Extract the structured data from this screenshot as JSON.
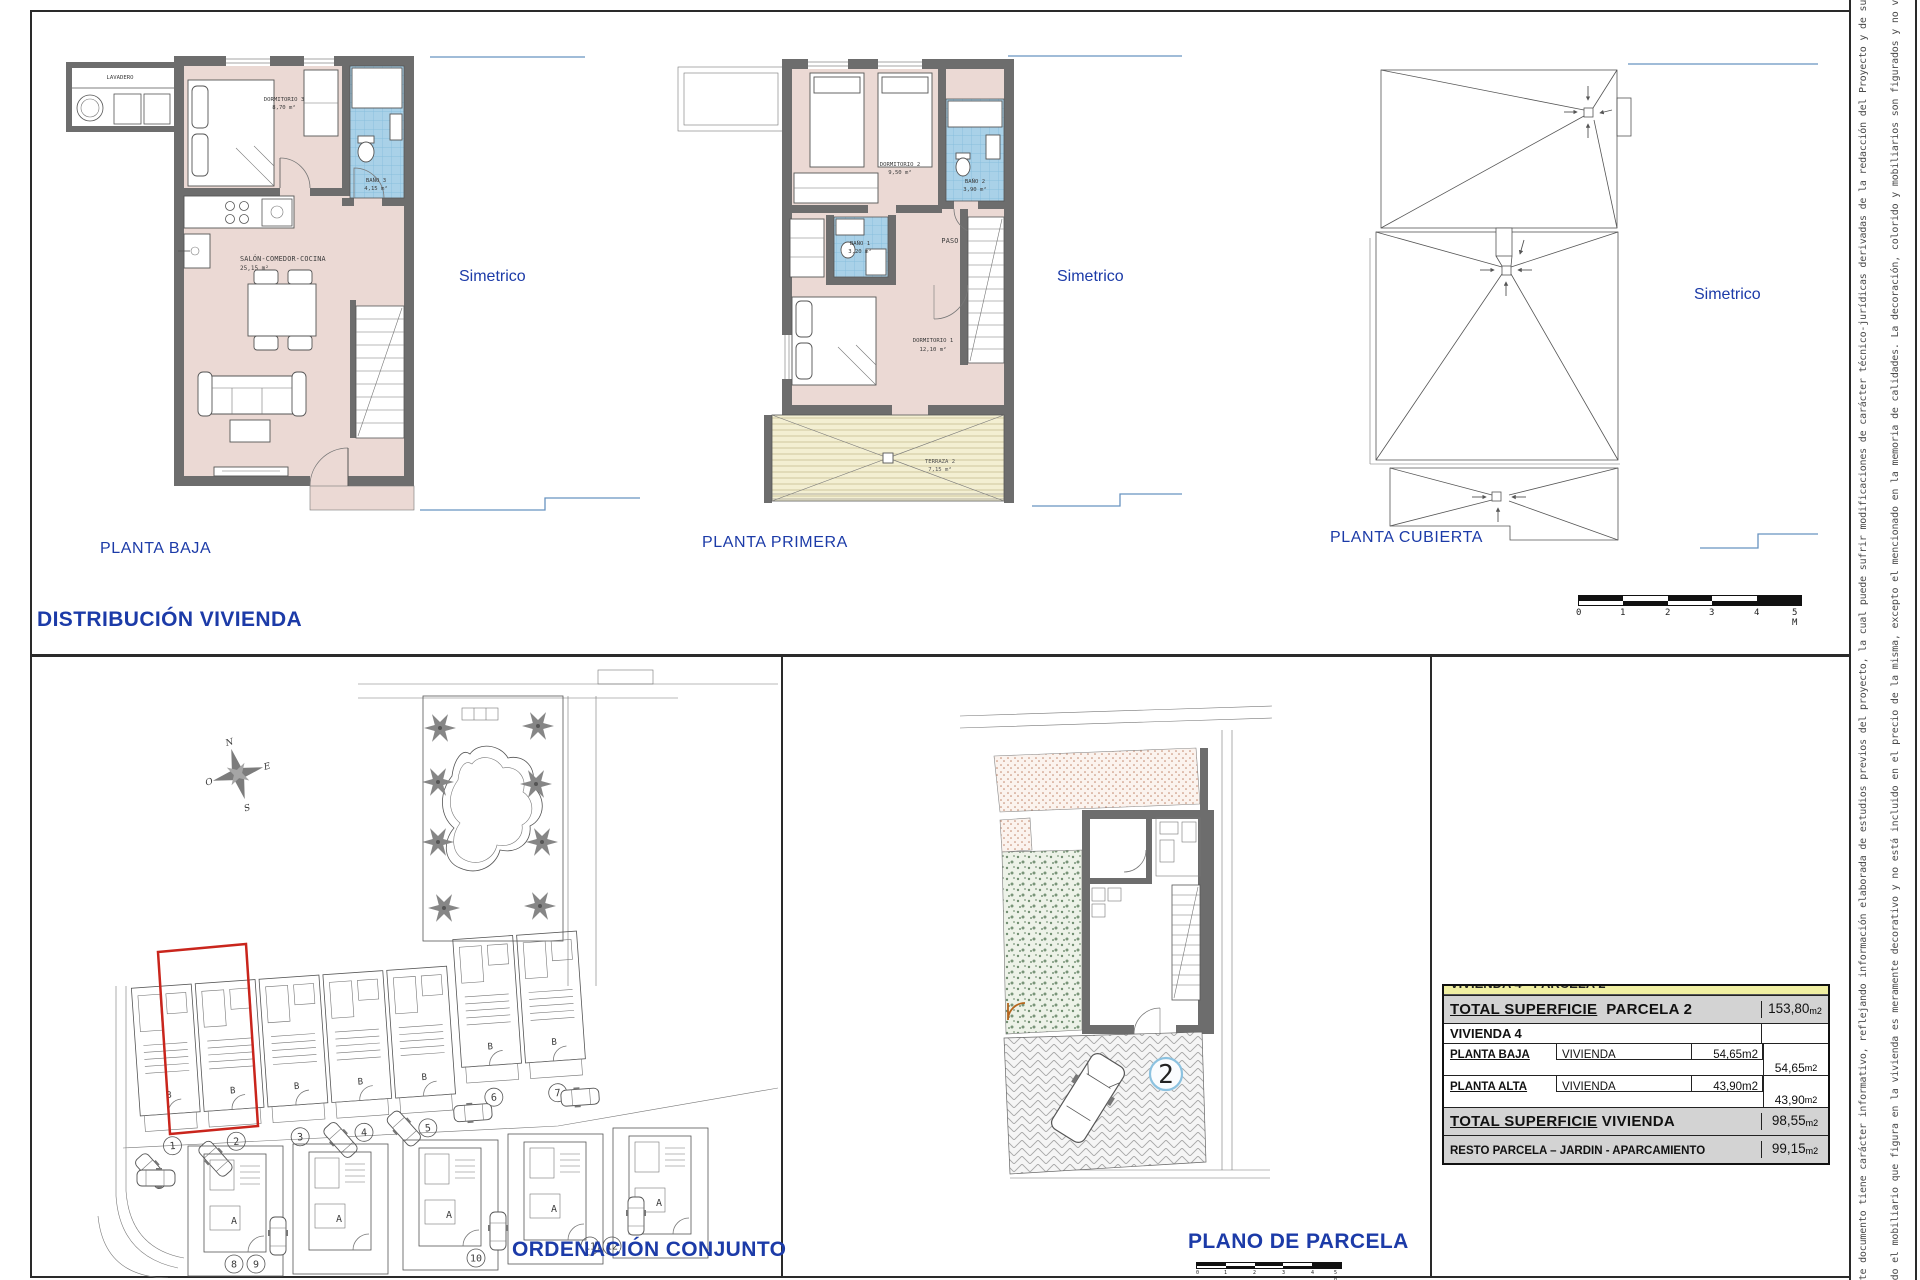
{
  "titles": {
    "distribucion": "DISTRIBUCIÓN  VIVIENDA",
    "ordenacion": "ORDENACIÓN CONJUNTO",
    "plano_parcela": "PLANO DE PARCELA"
  },
  "plans": {
    "planta_baja": {
      "label": "PLANTA BAJA",
      "simetrico": "Simetrico",
      "lavadero": "LAVADERO",
      "dormitorio3_name": "DORMITORIO 3",
      "dormitorio3_area": "8,70 m²",
      "bano3_name": "BAÑO 3",
      "bano3_area": "4,15 m²",
      "salon_name": "SALÓN-COMEDOR-COCINA",
      "salon_area": "25,15 m²"
    },
    "planta_primera": {
      "label": "PLANTA PRIMERA",
      "simetrico": "Simetrico",
      "dormitorio2_name": "DORMITORIO 2",
      "dormitorio2_area": "9,50 m²",
      "bano2_name": "BAÑO 2",
      "bano2_area": "3,90 m²",
      "bano1_name": "BAÑO 1",
      "bano1_area": "3,20 m²",
      "paso": "PASO",
      "dormitorio1_name": "DORMITORIO 1",
      "dormitorio1_area": "12,10 m²",
      "terraza_name": "TERRAZA 2",
      "terraza_area": "7,15 m²"
    },
    "planta_cubierta": {
      "label": "PLANTA CUBIERTA",
      "simetrico": "Simetrico"
    }
  },
  "scalebar": {
    "ticks": [
      "0",
      "1",
      "2",
      "3",
      "4",
      "5 M"
    ]
  },
  "scalebar_small": {
    "ticks": [
      "0",
      "1",
      "2",
      "3",
      "4",
      "5 M"
    ]
  },
  "site_plan": {
    "compass": {
      "n": "N",
      "e": "E",
      "s": "S",
      "o": "O"
    },
    "letter_top": "B",
    "letter_bottom": "A",
    "numbers_top": [
      "1",
      "2",
      "3",
      "4",
      "5",
      "6",
      "7"
    ],
    "numbers_bottom": [
      "8",
      "9",
      "10",
      "11",
      "12"
    ]
  },
  "parcel_plan": {
    "number": "2"
  },
  "table": {
    "clipped_header": "VIVIENDA 4  -  PARCELA 2",
    "parcela_label_main": "TOTAL  SUPERFICIE",
    "parcela_label_rest": "PARCELA  2",
    "parcela_value": "153,80",
    "parcela_unit": "m2",
    "vivienda_label": "VIVIENDA  4",
    "baja_label": "PLANTA  BAJA",
    "baja_mid": "VIVIENDA",
    "baja_value": "54,65m2",
    "baja_total": "54,65",
    "baja_total_unit": "m2",
    "alta_label": "PLANTA  ALTA",
    "alta_mid": "VIVIENDA",
    "alta_value": "43,90m2",
    "alta_total": "43,90",
    "alta_total_unit": "m2",
    "total_label_main": "TOTAL  SUPERFICIE",
    "total_label_rest": "VIVIENDA",
    "total_value": "98,55",
    "total_unit": "m2",
    "resto_label": "RESTO PARCELA – JARDIN - APARCAMIENTO",
    "resto_value": "99,15",
    "resto_unit": "m2"
  },
  "disclaimer": {
    "line1": "Este documento tiene carácter informativo, reflejando información elaborada de estudios previos del proyecto, la cual puede sufrir modificaciones de carácter técnico-jurídicas derivadas de la redacción del Proyecto y de su ejecución.",
    "line2": "Todo el mobiliario que figura en la vivienda es meramente decorativo y no está incluido en el precio de la misma, excepto el mencionado en la memoria de calidades. La decoración, colorido y mobiliarios son figurados y no vinculantes."
  }
}
